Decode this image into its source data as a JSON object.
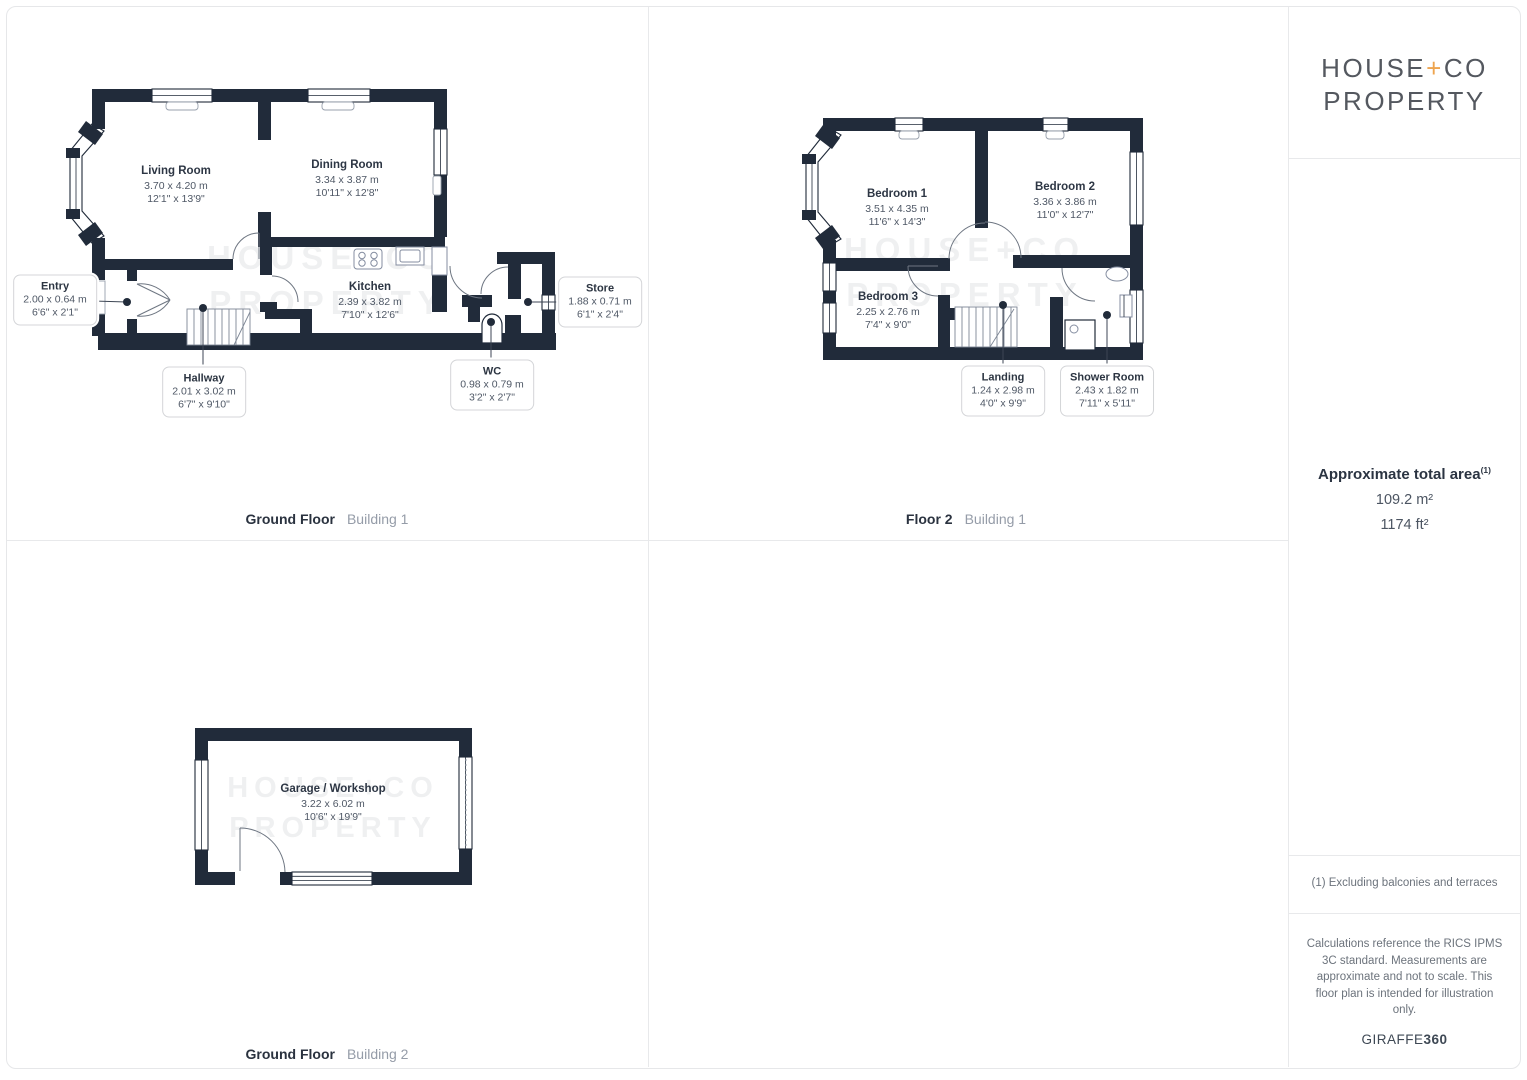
{
  "panels": {
    "gf1": {
      "caption": {
        "bold": "Ground Floor",
        "light": "Building 1"
      },
      "rooms": {
        "living": {
          "name": "Living Room",
          "metric": "3.70 x 4.20 m",
          "imperial": "12'1\" x 13'9\""
        },
        "dining": {
          "name": "Dining Room",
          "metric": "3.34 x 3.87 m",
          "imperial": "10'11\" x 12'8\""
        },
        "kitchen": {
          "name": "Kitchen",
          "metric": "2.39 x 3.82 m",
          "imperial": "7'10\" x 12'6\""
        },
        "entry": {
          "name": "Entry",
          "metric": "2.00 x 0.64 m",
          "imperial": "6'6\" x 2'1\""
        },
        "hallway": {
          "name": "Hallway",
          "metric": "2.01 x 3.02 m",
          "imperial": "6'7\" x 9'10\""
        },
        "wc": {
          "name": "WC",
          "metric": "0.98 x 0.79 m",
          "imperial": "3'2\" x 2'7\""
        },
        "store": {
          "name": "Store",
          "metric": "1.88 x 0.71 m",
          "imperial": "6'1\" x 2'4\""
        }
      }
    },
    "f2": {
      "caption": {
        "bold": "Floor 2",
        "light": "Building 1"
      },
      "rooms": {
        "bedroom1": {
          "name": "Bedroom 1",
          "metric": "3.51 x 4.35 m",
          "imperial": "11'6\" x 14'3\""
        },
        "bedroom2": {
          "name": "Bedroom 2",
          "metric": "3.36 x 3.86 m",
          "imperial": "11'0\" x 12'7\""
        },
        "bedroom3": {
          "name": "Bedroom 3",
          "metric": "2.25 x 2.76 m",
          "imperial": "7'4\" x 9'0\""
        },
        "landing": {
          "name": "Landing",
          "metric": "1.24 x 2.98 m",
          "imperial": "4'0\" x 9'9\""
        },
        "shower": {
          "name": "Shower Room",
          "metric": "2.43 x 1.82 m",
          "imperial": "7'11\" x 5'11\""
        }
      }
    },
    "gf2": {
      "caption": {
        "bold": "Ground Floor",
        "light": "Building 2"
      },
      "rooms": {
        "garage": {
          "name": "Garage / Workshop",
          "metric": "3.22 x 6.02 m",
          "imperial": "10'6\" x 19'9\""
        }
      }
    }
  },
  "watermark": {
    "line1": "HOUSE+CO",
    "line2": "PROPERTY"
  },
  "sidebar": {
    "logo": {
      "word1": "HOUSE",
      "plus": "+",
      "word2": "CO",
      "line2": "PROPERTY"
    },
    "area_title": "Approximate total area",
    "area_note": "(1)",
    "area_metric": "109.2 m²",
    "area_imperial": "1174 ft²",
    "footnote": "(1) Excluding balconies and terraces",
    "disclaimer": "Calculations reference the RICS IPMS 3C standard. Measurements are approximate and not to scale. This floor plan is intended for illustration only.",
    "brand_word": "GIRAFFE",
    "brand_number": "360"
  },
  "colors": {
    "wall": "#212b3a",
    "accent_plus": "#eea44f"
  }
}
